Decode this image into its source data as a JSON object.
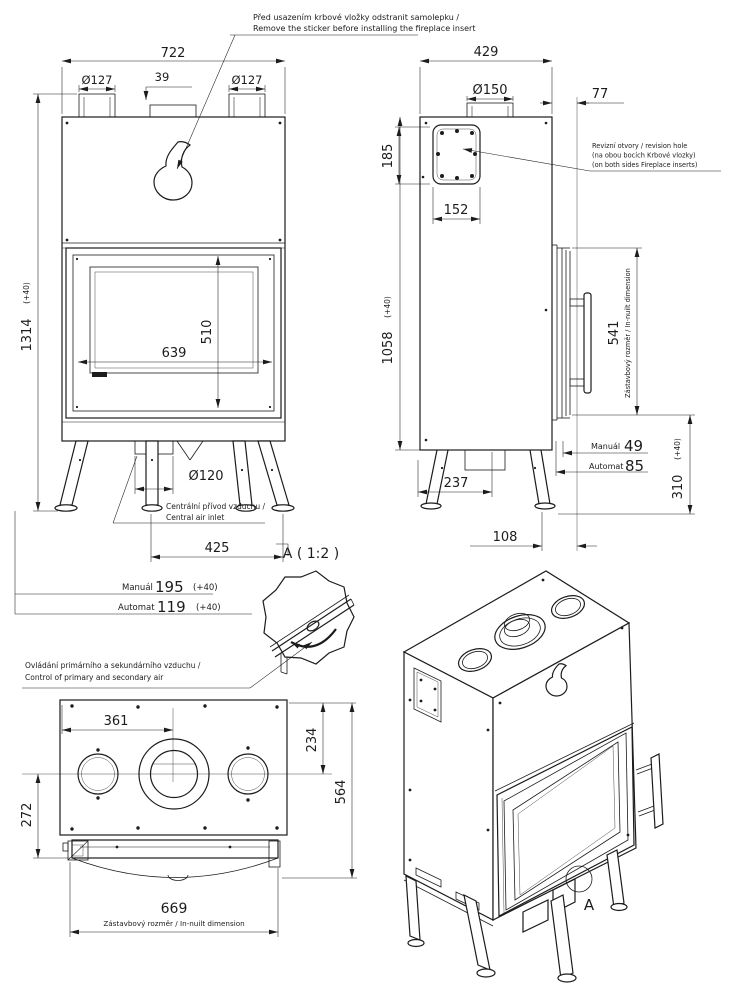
{
  "note_sticker": {
    "line1": "Před usazením krbové vložky odstranit samolepku /",
    "line2": "Remove the sticker before installing the fireplace insert"
  },
  "front_view": {
    "dim_width_total": "722",
    "dim_collar_left": "Ø127",
    "dim_collar_offset": "39",
    "dim_collar_right": "Ø127",
    "dim_height_total": "1314",
    "dim_height_total_tol": "(+40)",
    "dim_glass_width": "639",
    "dim_glass_height": "510",
    "dim_air_inlet": "Ø120",
    "note_air_inlet_cz": "Centrální přívod vzduchu /",
    "note_air_inlet_en": "Central air inlet",
    "dim_feet_span": "425",
    "manual_label": "Manuál",
    "manual_value": "195",
    "manual_tol": "(+40)",
    "automat_label": "Automat",
    "automat_value": "119",
    "automat_tol": "(+40)"
  },
  "side_view": {
    "dim_depth_total": "429",
    "dim_flue_collar": "Ø150",
    "dim_back_offset": "77",
    "dim_revision_height": "185",
    "dim_revision_width": "152",
    "note_revision_1": "Revizní otvory / revision hole",
    "note_revision_2": "(na obou bocích Krbové vlozky)",
    "note_revision_3": "(on both sides Fireplace inserts)",
    "dim_body_height": "1058",
    "dim_body_height_tol": "(+40)",
    "dim_inbuilt_height": "541",
    "label_inbuilt": "Zástavbový rozměr / In-nuilt dimension",
    "manual_label": "Manuál",
    "manual_value": "49",
    "automat_label": "Automat",
    "automat_value": "85",
    "dim_leg_height": "310",
    "dim_leg_height_tol": "(+40)",
    "dim_leg_span": "237",
    "dim_foot_offset": "108"
  },
  "detail_a": {
    "label": "A ( 1:2 )",
    "note_cz": "Ovládání primárního a sekundárního vzduchu /",
    "note_en": "Control of primary and secondary air"
  },
  "top_view": {
    "dim_collar_spacing": "361",
    "dim_center_offset": "234",
    "dim_front_offset": "272",
    "dim_depth_total": "564",
    "dim_inbuilt_width": "669",
    "label_inbuilt": "Zástavbový rozměr / In-nuilt dimension"
  },
  "iso_view": {
    "detail_marker": "A"
  }
}
